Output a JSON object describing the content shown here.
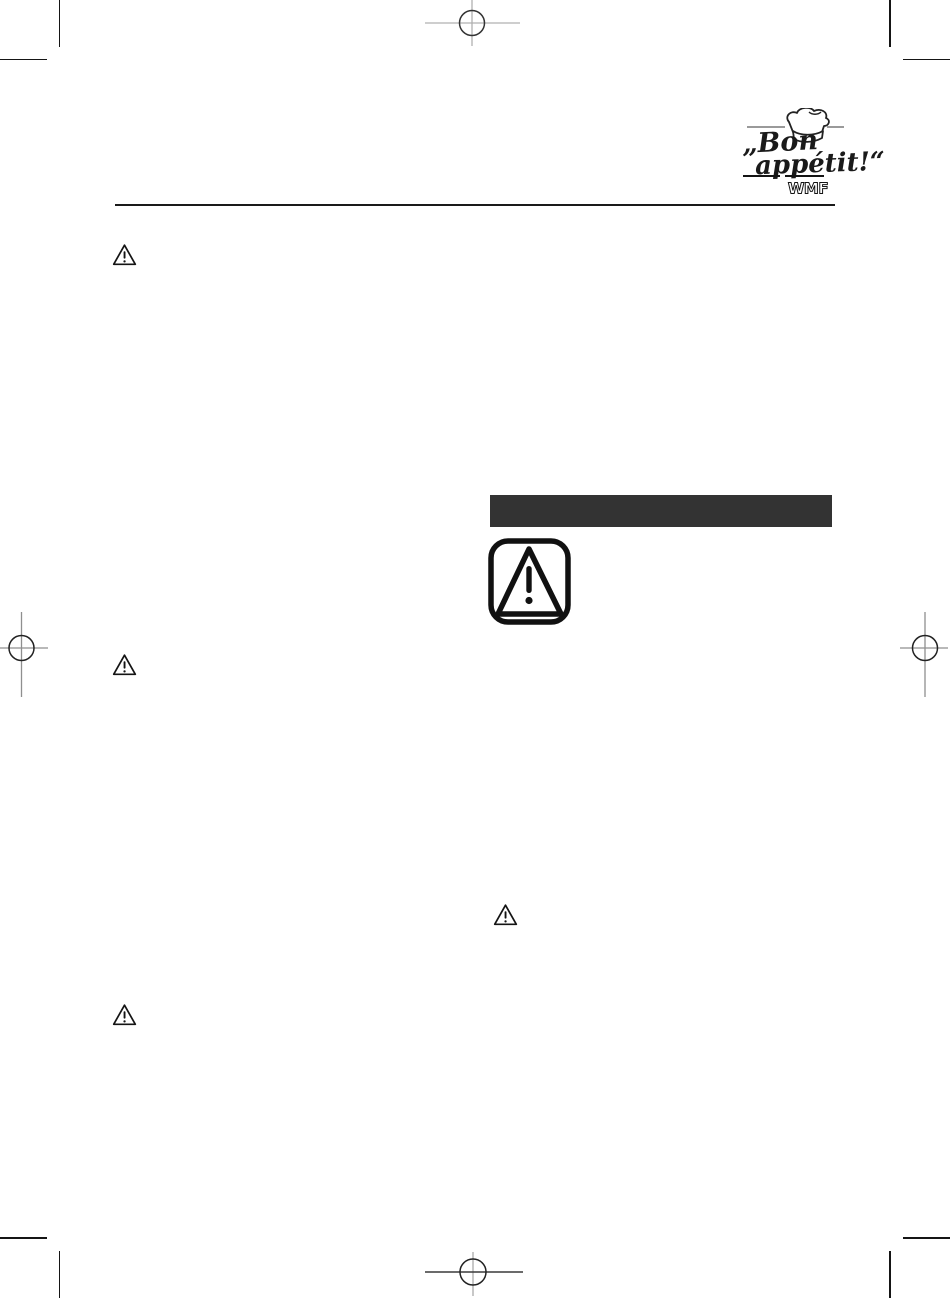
{
  "document": {
    "description": "Blank print-proof page of an instruction manual: printer's trim and registration marks, brand logo header, warning icons and an empty dark section bar",
    "background_color": "#ffffff"
  },
  "header": {
    "logo": {
      "text_line1": "„Bon",
      "text_line2": "appétit!“",
      "brand": "WMF",
      "icon": "chef-hat-icon"
    },
    "rule_color": "#1a1a1a"
  },
  "body": {
    "left_column": {
      "small_warning_icon_count": 3,
      "small_warning_icon": "triangle-exclamation-outline"
    },
    "right_column": {
      "section_bar_color": "#333333",
      "section_bar_text": "",
      "large_warning_sign": "triangle-exclamation-in-rounded-square",
      "small_warning_icon_count": 1
    }
  },
  "print_marks": {
    "trim_mark_corners": [
      "top-left",
      "top-right",
      "bottom-left",
      "bottom-right"
    ],
    "registration_marks": [
      "top-center",
      "left-middle",
      "right-middle",
      "bottom-center"
    ]
  },
  "colors": {
    "ink": "#1a1a1a",
    "section_bar": "#333333",
    "mark_gray": "#9a9a9a",
    "mark_dark": "#333333",
    "mark_light": "#c8c8c8"
  }
}
